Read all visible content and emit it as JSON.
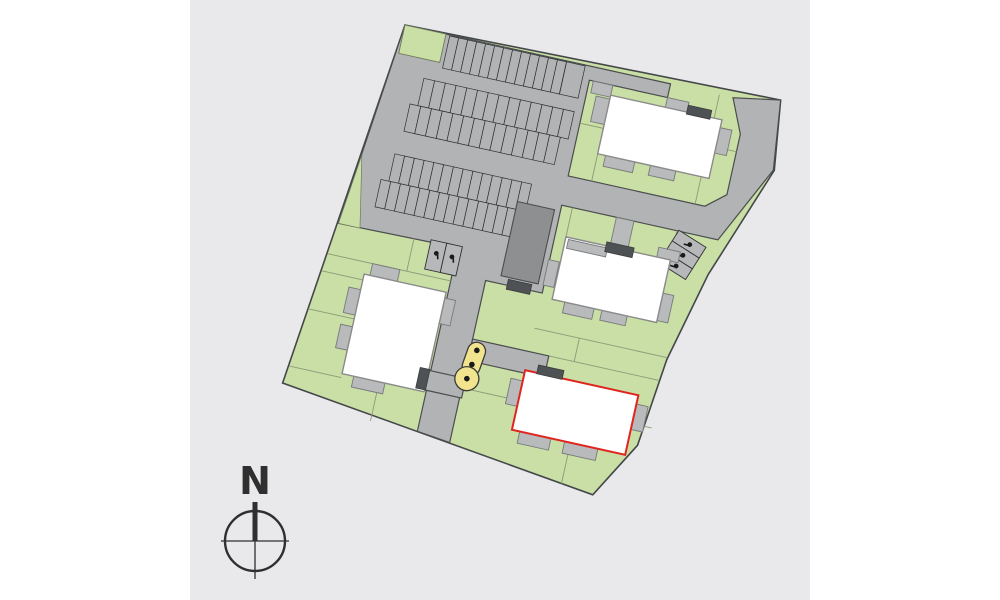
{
  "title": "residential-site-plan",
  "compass": {
    "north_label": "N"
  },
  "colors": {
    "page_background": "#ffffff",
    "panel_background": "#e9e9eb",
    "asphalt": "#b2b3b5",
    "lawn_green": "#c9dfa5",
    "site_outline": "#44474a",
    "building_fill": "#ffffff",
    "building_stroke": "#8a8a8a",
    "terrace_gray": "#b9babc",
    "entrance_dark": "#4f5254",
    "carport_gray": "#8e8f91",
    "highlight_red": "#e0251f",
    "playground_yellow": "#f2e48e",
    "icon_black": "#1a1a1a",
    "compass_ink": "#2f2f2f"
  },
  "site": {
    "buildings": [
      {
        "id": "north",
        "name": "building-north",
        "highlighted": false
      },
      {
        "id": "middle",
        "name": "building-middle",
        "highlighted": false
      },
      {
        "id": "west",
        "name": "building-west",
        "highlighted": false
      },
      {
        "id": "selected",
        "name": "building-selected",
        "highlighted": true
      }
    ],
    "parking": {
      "rows": [
        {
          "name": "top-row",
          "x": 46,
          "y": 1,
          "count": 13,
          "w": 9.2,
          "h": 33
        },
        {
          "name": "top-row-wide",
          "x": 165.8,
          "y": 1,
          "count": 1,
          "w": 19,
          "h": 33
        },
        {
          "name": "block-a-upper",
          "x": 30,
          "y": 48,
          "count": 14,
          "w": 11,
          "h": 28
        },
        {
          "name": "block-a-lower",
          "x": 22,
          "y": 76,
          "count": 14,
          "w": 11,
          "h": 28
        },
        {
          "name": "block-b-upper",
          "x": 18,
          "y": 128,
          "count": 14,
          "w": 10,
          "h": 28
        },
        {
          "name": "block-b-lower",
          "x": 10,
          "y": 156,
          "count": 14,
          "w": 10,
          "h": 28
        }
      ],
      "accessible_groups": [
        {
          "name": "south-pair",
          "transform": "translate(72,204)",
          "count": 2,
          "w": 16,
          "h": 30,
          "icon_y": 14
        },
        {
          "name": "east-trio",
          "transform": "translate(342,152) rotate(110)",
          "count": 3,
          "w": 12.7,
          "h": 32,
          "icon_y": 17
        }
      ]
    },
    "playground": {
      "dot_count": 3,
      "dot_spacing": 15,
      "first_dot_y": 302,
      "dot_x": 139
    }
  }
}
